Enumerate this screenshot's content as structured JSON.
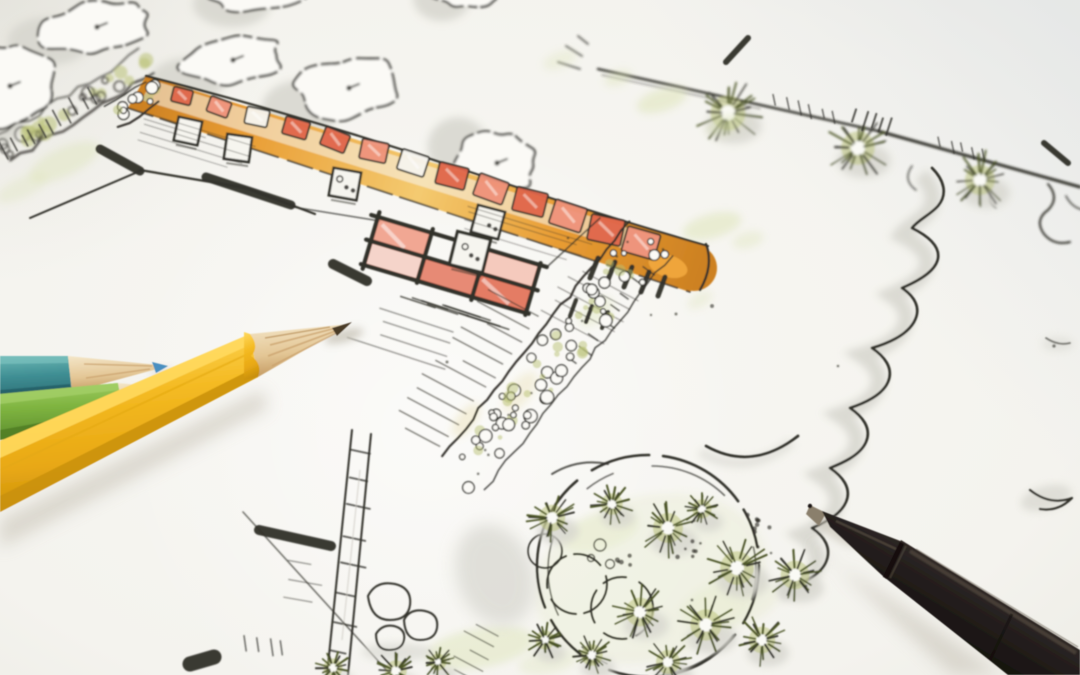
{
  "scene": {
    "description": "Photograph of a hand-drawn landscape architecture garden plan sketched in ink and watercolor, with three colored pencils (teal, green, yellow) lying at the lower left and a black fineliner pen at the lower right",
    "objects": {
      "plan": "garden plan sketch with trees, orange paver path, terrace grid, gravel band, round planting bed, fence with shrubs",
      "pencils": [
        "teal colored pencil",
        "green colored pencil",
        "yellow colored pencil"
      ],
      "pen": "black fineliner pen"
    }
  },
  "colors": {
    "paper": "#f6f5f1",
    "paper_edge": "#ecebe5",
    "shadow": "#d6d5ce",
    "ink": "#31302a",
    "ink_soft": "#5a564e",
    "wash_green": "#dce3b4",
    "olive": "#b9c176",
    "olive_dark": "#79863f",
    "olive_deep": "#4c5527",
    "path_orange": "#e89c33",
    "path_orange_light": "#f4ca70",
    "path_orange_dark": "#cd8122",
    "paver_red": "#e0664a",
    "paver_pink": "#ef927a",
    "pencil_yellow": "#f4ba22",
    "pencil_yellow_hi": "#ffd95e",
    "pencil_yellow_dark": "#c9900c",
    "pencil_green": "#7fb440",
    "pencil_green_hi": "#a2ce66",
    "pencil_green_dark": "#4f7d26",
    "pencil_teal": "#3f8e93",
    "pencil_teal_hi": "#6cb8b5",
    "pencil_teal_dark": "#245d64",
    "wood": "#eed9b2",
    "wood_dark": "#c9a06b",
    "lead": "#4a3a28",
    "lead_blue": "#4a8fc0",
    "pen_body": "#292320",
    "pen_hi": "#4d443b",
    "pen_metal": "#8a7f6c"
  },
  "plan": {
    "trees": [
      {
        "cx": 97,
        "cy": 27,
        "rx": 57,
        "ry": 25,
        "rot": -7,
        "sdx": -48,
        "sdy": 14,
        "seed": 3
      },
      {
        "cx": 233,
        "cy": 60,
        "rx": 52,
        "ry": 23,
        "rot": -7,
        "sdx": -45,
        "sdy": 20,
        "seed": 5
      },
      {
        "cx": 349,
        "cy": 88,
        "rx": 54,
        "ry": 29,
        "rot": -7,
        "sdx": -48,
        "sdy": 20,
        "seed": 8
      },
      {
        "cx": 497,
        "cy": 163,
        "rx": 42,
        "ry": 31,
        "rot": -5,
        "sdx": -39,
        "sdy": -16,
        "seed": 11
      },
      {
        "cx": 262,
        "cy": -12,
        "rx": 54,
        "ry": 24,
        "rot": -4,
        "sdx": -30,
        "sdy": 16,
        "seed": 13
      },
      {
        "cx": 10,
        "cy": 86,
        "rx": 48,
        "ry": 40,
        "rot": 0,
        "sdx": -18,
        "sdy": 24,
        "seed": 17
      },
      {
        "cx": 468,
        "cy": -16,
        "rx": 40,
        "ry": 24,
        "rot": -4,
        "sdx": -26,
        "sdy": 14,
        "seed": 19
      }
    ],
    "fence_shrubs": [
      {
        "x": 728,
        "y": 113,
        "r": 29,
        "seed": 23
      },
      {
        "x": 858,
        "y": 148,
        "r": 28,
        "seed": 29
      },
      {
        "x": 980,
        "y": 180,
        "r": 25,
        "seed": 31
      }
    ],
    "bed_plants": [
      {
        "x": 552,
        "y": 518,
        "r": 22,
        "seed": 41
      },
      {
        "x": 612,
        "y": 504,
        "r": 18,
        "seed": 43
      },
      {
        "x": 668,
        "y": 528,
        "r": 25,
        "seed": 47
      },
      {
        "x": 702,
        "y": 509,
        "r": 16,
        "seed": 53
      },
      {
        "x": 737,
        "y": 568,
        "r": 28,
        "seed": 59
      },
      {
        "x": 795,
        "y": 575,
        "r": 24,
        "seed": 61
      },
      {
        "x": 640,
        "y": 612,
        "r": 24,
        "seed": 67
      },
      {
        "x": 706,
        "y": 625,
        "r": 26,
        "seed": 71
      },
      {
        "x": 762,
        "y": 640,
        "r": 22,
        "seed": 73
      },
      {
        "x": 668,
        "y": 662,
        "r": 20,
        "seed": 79
      },
      {
        "x": 592,
        "y": 655,
        "r": 18,
        "seed": 83
      },
      {
        "x": 545,
        "y": 640,
        "r": 16,
        "seed": 89
      }
    ],
    "extra_plants": [
      {
        "x": 333,
        "y": 668,
        "r": 16,
        "seed": 97
      },
      {
        "x": 396,
        "y": 671,
        "r": 18,
        "seed": 101
      },
      {
        "x": 438,
        "y": 662,
        "r": 14,
        "seed": 103
      }
    ],
    "pavers": [
      {
        "x": 182,
        "y": 96,
        "w": 20,
        "h": 15,
        "rot": 14,
        "tone": "red"
      },
      {
        "x": 219,
        "y": 107,
        "w": 22,
        "h": 16,
        "rot": 20,
        "tone": "pink"
      },
      {
        "x": 257,
        "y": 117,
        "w": 23,
        "h": 17,
        "rot": 12,
        "tone": "white"
      },
      {
        "x": 296,
        "y": 128,
        "w": 25,
        "h": 18,
        "rot": 16,
        "tone": "red"
      },
      {
        "x": 335,
        "y": 140,
        "w": 26,
        "h": 19,
        "rot": 22,
        "tone": "red"
      },
      {
        "x": 374,
        "y": 151,
        "w": 27,
        "h": 20,
        "rot": 12,
        "tone": "pink"
      },
      {
        "x": 413,
        "y": 163,
        "w": 28,
        "h": 21,
        "rot": 18,
        "tone": "white"
      },
      {
        "x": 452,
        "y": 176,
        "w": 30,
        "h": 22,
        "rot": 14,
        "tone": "red"
      },
      {
        "x": 491,
        "y": 189,
        "w": 31,
        "h": 23,
        "rot": 20,
        "tone": "pink"
      },
      {
        "x": 530,
        "y": 202,
        "w": 32,
        "h": 24,
        "rot": 14,
        "tone": "red"
      },
      {
        "x": 568,
        "y": 216,
        "w": 33,
        "h": 25,
        "rot": 18,
        "tone": "pink"
      },
      {
        "x": 606,
        "y": 230,
        "w": 34,
        "h": 26,
        "rot": 12,
        "tone": "red"
      },
      {
        "x": 641,
        "y": 243,
        "w": 34,
        "h": 26,
        "rot": 16,
        "tone": "pink"
      }
    ],
    "squares": [
      {
        "x": 188,
        "y": 131,
        "s": 24,
        "rot": 12,
        "dots": 0
      },
      {
        "x": 238,
        "y": 148,
        "s": 25,
        "rot": 8,
        "dots": 0
      },
      {
        "x": 345,
        "y": 184,
        "s": 28,
        "rot": 10,
        "dots": 2
      },
      {
        "x": 488,
        "y": 222,
        "s": 28,
        "rot": 15,
        "dots": 1
      },
      {
        "x": 470,
        "y": 252,
        "s": 34,
        "rot": 14,
        "dots": 2
      }
    ],
    "pebble_band": {
      "x1": 650,
      "y1": 238,
      "x2": 456,
      "y2": 482,
      "w": 54,
      "n": 85,
      "seed": 7
    },
    "pebble_mini": {
      "x1": 112,
      "y1": 118,
      "x2": 158,
      "y2": 88,
      "w": 24,
      "n": 12,
      "seed": 15
    },
    "hedge": {
      "x1": 4,
      "y1": 150,
      "x2": 154,
      "y2": 58,
      "w": 27,
      "n": 30,
      "seed": 21
    },
    "bars": [
      [
        100,
        149,
        140,
        171,
        9
      ],
      [
        206,
        177,
        291,
        205,
        9
      ],
      [
        333,
        264,
        367,
        281,
        10
      ],
      [
        259,
        530,
        331,
        546,
        10
      ],
      [
        598,
        258,
        590,
        278,
        5
      ],
      [
        615,
        262,
        607,
        282,
        5
      ],
      [
        632,
        267,
        624,
        287,
        5
      ],
      [
        649,
        272,
        641,
        292,
        5
      ],
      [
        665,
        277,
        658,
        296,
        5
      ],
      [
        576,
        300,
        570,
        316,
        4
      ],
      [
        592,
        306,
        586,
        322,
        4
      ],
      [
        608,
        312,
        602,
        328,
        4
      ],
      [
        726,
        62,
        748,
        38,
        6
      ],
      [
        1044,
        143,
        1068,
        163,
        6
      ],
      [
        190,
        664,
        214,
        657,
        15
      ]
    ],
    "hatches": [
      {
        "x": 10,
        "y": 158,
        "dir": -32,
        "angle": -118,
        "len": 15,
        "n": 11,
        "gap": 10,
        "w": 1.6,
        "o": 0.8,
        "seed": 111
      },
      {
        "x": 148,
        "y": 112,
        "dir": 107,
        "angle": 17,
        "len": 90,
        "n": 5,
        "gap": 7,
        "w": 1,
        "o": 0.4,
        "seed": 113
      },
      {
        "x": 470,
        "y": 205,
        "dir": 107,
        "angle": 17,
        "len": 120,
        "n": 4,
        "gap": 8,
        "w": 1.2,
        "o": 0.35,
        "seed": 117
      },
      {
        "x": 352,
        "y": 448,
        "dir": 96,
        "angle": 12,
        "len": 20,
        "n": 8,
        "gap": 29,
        "w": 1.8,
        "o": 0.8,
        "seed": 119
      },
      {
        "x": 437,
        "y": 306,
        "dir": 17,
        "angle": 198,
        "len": 40,
        "n": 8,
        "gap": 11,
        "w": 1.6,
        "o": 0.75,
        "seed": 121
      },
      {
        "x": 455,
        "y": 330,
        "dir": 107,
        "angle": 198,
        "len": 95,
        "n": 4,
        "gap": 13,
        "w": 1.3,
        "o": 0.5,
        "seed": 127
      },
      {
        "x": 540,
        "y": 318,
        "dir": 128,
        "angle": 208,
        "len": 46,
        "n": 12,
        "gap": 15,
        "w": 1.4,
        "o": 0.6,
        "seed": 131
      },
      {
        "x": 652,
        "y": 252,
        "dir": 128,
        "angle": 36,
        "len": 13,
        "n": 9,
        "gap": 17,
        "w": 1.6,
        "o": 0.7,
        "seed": 137
      },
      {
        "x": 775,
        "y": 96,
        "dir": 14,
        "angle": 78,
        "len": 11,
        "n": 6,
        "gap": 12,
        "w": 1.5,
        "o": 0.7,
        "seed": 139
      },
      {
        "x": 940,
        "y": 138,
        "dir": 14,
        "angle": 78,
        "len": 10,
        "n": 5,
        "gap": 11,
        "w": 1.5,
        "o": 0.7,
        "seed": 149
      },
      {
        "x": 858,
        "y": 110,
        "dir": 16,
        "angle": 108,
        "len": 15,
        "n": 5,
        "gap": 9,
        "w": 2,
        "o": 0.8,
        "seed": 151
      },
      {
        "x": 246,
        "y": 636,
        "dir": 5,
        "angle": 82,
        "len": 13,
        "n": 4,
        "gap": 12,
        "w": 1.5,
        "o": 0.7,
        "seed": 157
      },
      {
        "x": 500,
        "y": 636,
        "dir": 115,
        "angle": 208,
        "len": 28,
        "n": 6,
        "gap": 13,
        "w": 1.4,
        "o": 0.6,
        "seed": 163
      },
      {
        "x": 290,
        "y": 560,
        "dir": 100,
        "angle": 10,
        "len": 30,
        "n": 3,
        "gap": 18,
        "w": 1.2,
        "o": 0.5,
        "seed": 167
      },
      {
        "x": 640,
        "y": 300,
        "dir": 128,
        "angle": 208,
        "len": 60,
        "n": 5,
        "gap": 14,
        "w": 1.2,
        "o": 0.45,
        "seed": 173
      }
    ],
    "washes": [
      [
        662,
        100,
        26,
        11,
        -18,
        0.5
      ],
      [
        726,
        125,
        20,
        9,
        -18,
        0.45
      ],
      [
        618,
        78,
        14,
        7,
        -18,
        0.4
      ],
      [
        712,
        226,
        30,
        12,
        -15,
        0.5
      ],
      [
        748,
        240,
        16,
        8,
        -15,
        0.35
      ],
      [
        64,
        162,
        38,
        14,
        -25,
        0.4
      ],
      [
        22,
        188,
        28,
        10,
        -25,
        0.3
      ],
      [
        480,
        648,
        55,
        20,
        -10,
        0.45
      ],
      [
        548,
        662,
        30,
        12,
        -10,
        0.3
      ],
      [
        650,
        578,
        118,
        82,
        -15,
        0.2
      ],
      [
        600,
        532,
        40,
        18,
        -15,
        0.28
      ],
      [
        730,
        604,
        50,
        24,
        -15,
        0.22
      ],
      [
        596,
        312,
        20,
        10,
        -40,
        0.35
      ],
      [
        700,
        300,
        14,
        7,
        -30,
        0.3
      ],
      [
        560,
        60,
        18,
        8,
        -20,
        0.3
      ],
      [
        520,
        392,
        24,
        11,
        -52,
        0.3,
        "#e7d9a2"
      ],
      [
        466,
        420,
        20,
        9,
        -52,
        0.35,
        "#e7d9a2"
      ]
    ],
    "gravel": [
      {
        "x": 688,
        "y": 548,
        "n": 7,
        "r": 14
      },
      {
        "x": 757,
        "y": 521,
        "n": 9,
        "r": 16
      },
      {
        "x": 624,
        "y": 562,
        "n": 5,
        "r": 10
      }
    ],
    "specks": [
      [
        712,
        306,
        2
      ],
      [
        676,
        314,
        1.5
      ],
      [
        758,
        547,
        1.7
      ],
      [
        771,
        553,
        1.3
      ],
      [
        692,
        600,
        1.5
      ],
      [
        651,
        315,
        1.2
      ],
      [
        447,
        362,
        1.5
      ],
      [
        568,
        238,
        1.3
      ],
      [
        1054,
        346,
        1.8
      ],
      [
        838,
        366,
        1.3
      ],
      [
        806,
        586,
        1.4
      ]
    ]
  }
}
